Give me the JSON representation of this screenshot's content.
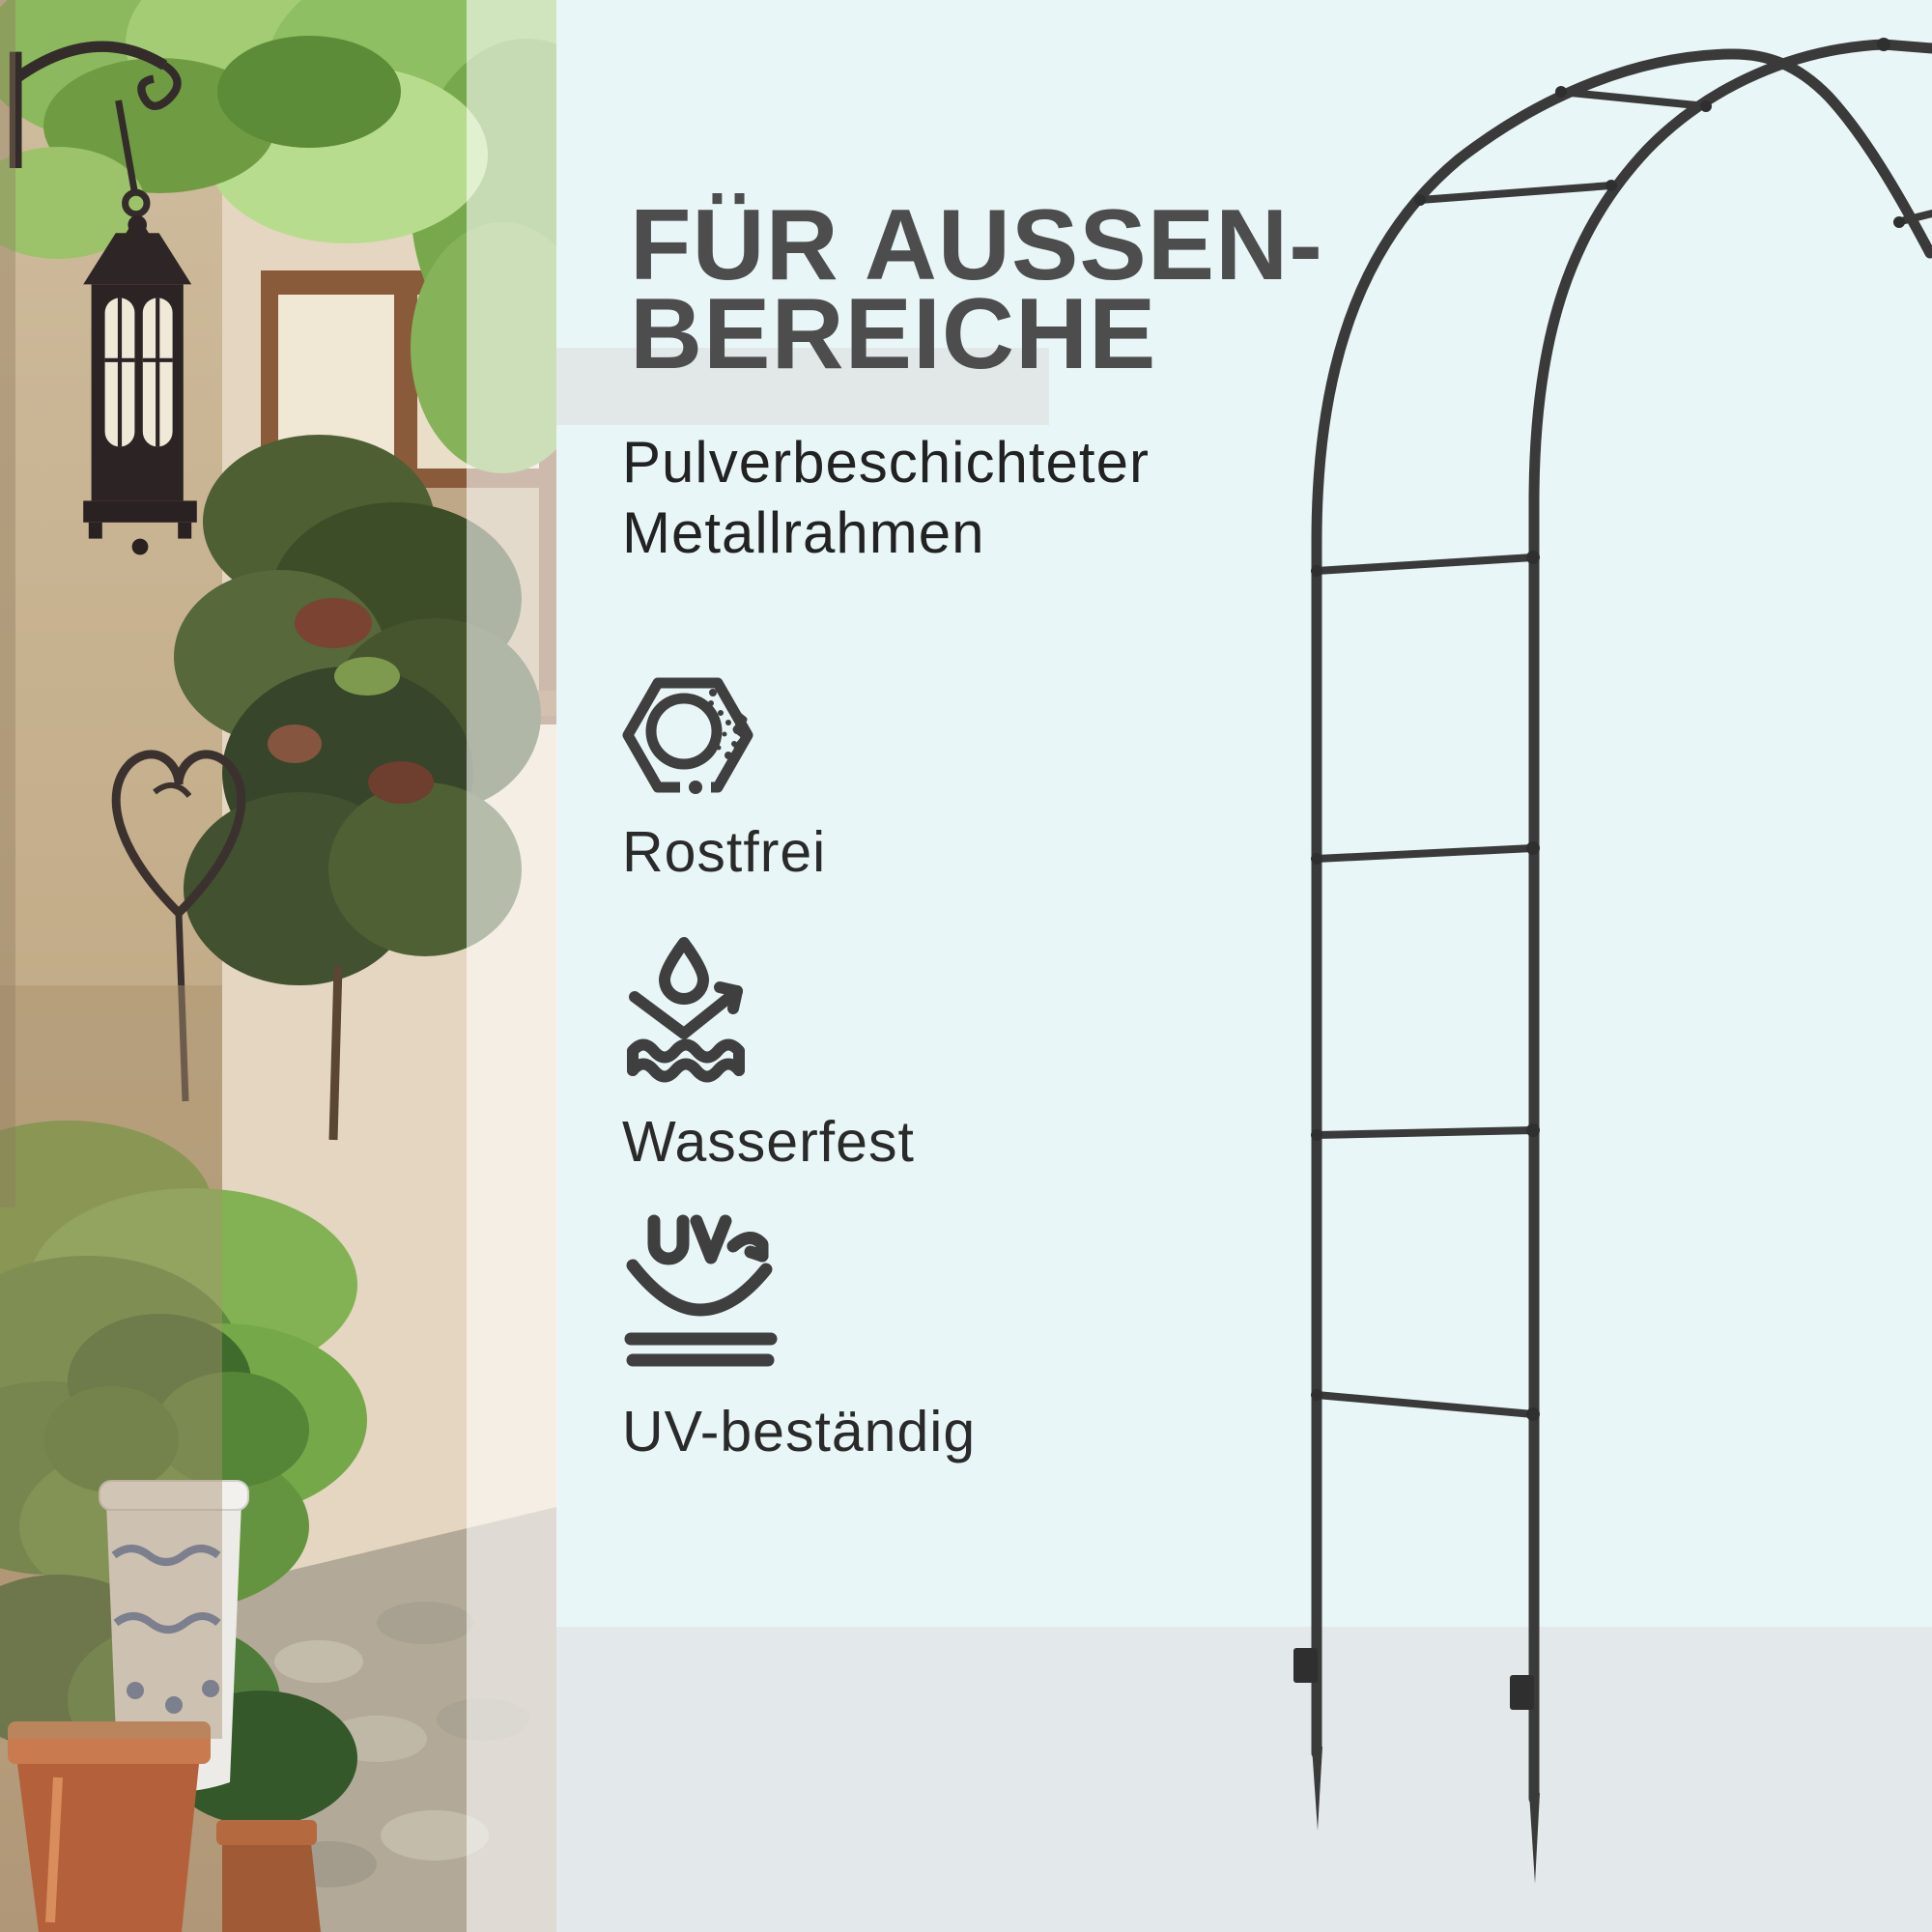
{
  "page": {
    "panel_color": "#e9f6f7",
    "floor_color": "#e3e9ea",
    "accent_bar_color": "#e2e7e8"
  },
  "headline": {
    "line1": "FÜR AUSSEN-",
    "line2": "BEREICHE",
    "color": "#4d4d4d"
  },
  "subtitle": {
    "line1": "Pulverbeschichteter",
    "line2": "Metallrahmen"
  },
  "features": [
    {
      "icon": "rust-free-nut-icon",
      "label": "Rostfrei"
    },
    {
      "icon": "waterproof-droplet-icon",
      "label": "Wasserfest"
    },
    {
      "icon": "uv-resistant-icon",
      "label": "UV-beständig"
    }
  ],
  "product": {
    "frame_color": "#3a3a3a"
  }
}
